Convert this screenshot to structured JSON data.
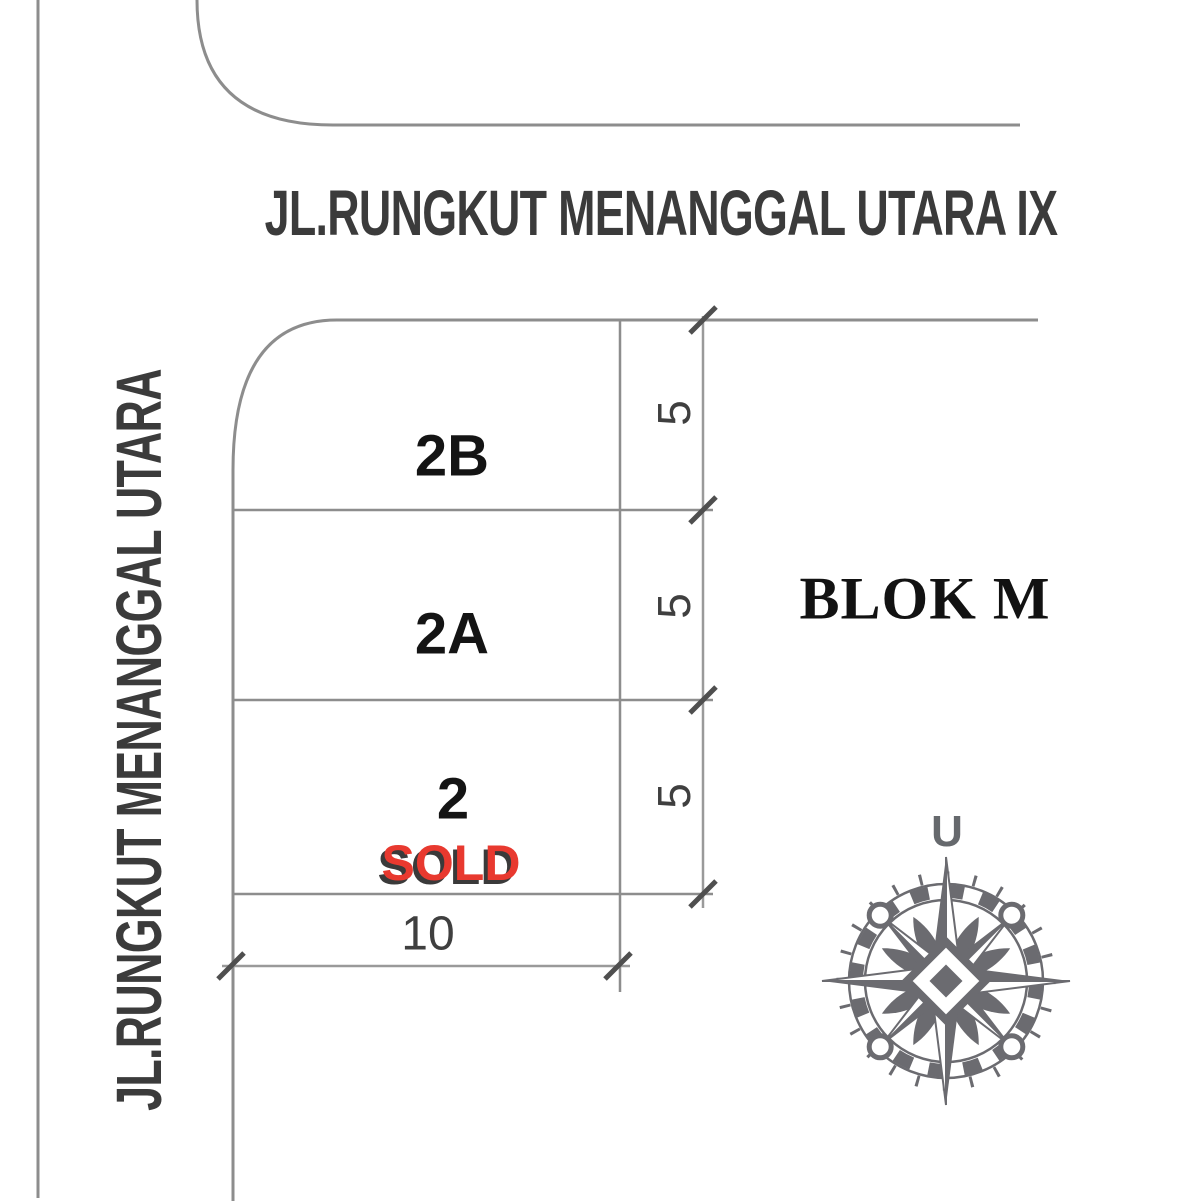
{
  "streets": {
    "top": "JL.RUNGKUT MENANGGAL UTARA IX",
    "left": "JL.RUNGKUT MENANGGAL UTARA"
  },
  "block": {
    "label": "BLOK M"
  },
  "plots": [
    {
      "label": "2B"
    },
    {
      "label": "2A"
    },
    {
      "label": "2",
      "status": "SOLD"
    }
  ],
  "dimensions": {
    "plot_depths": [
      "5",
      "5",
      "5"
    ],
    "plot_width": "10"
  },
  "compass": {
    "north_label": "U"
  },
  "colors": {
    "line": "#8d8d8d",
    "dimension_line": "#9a9a9a",
    "dimension_tick": "#4f4f4f",
    "street_text": "#3b3b3b",
    "plot_text": "#141414",
    "sold_red": "#e8392f",
    "sold_shadow": "#3a3a3a",
    "block_text": "#121212",
    "compass_gray": "#6b6b70"
  }
}
